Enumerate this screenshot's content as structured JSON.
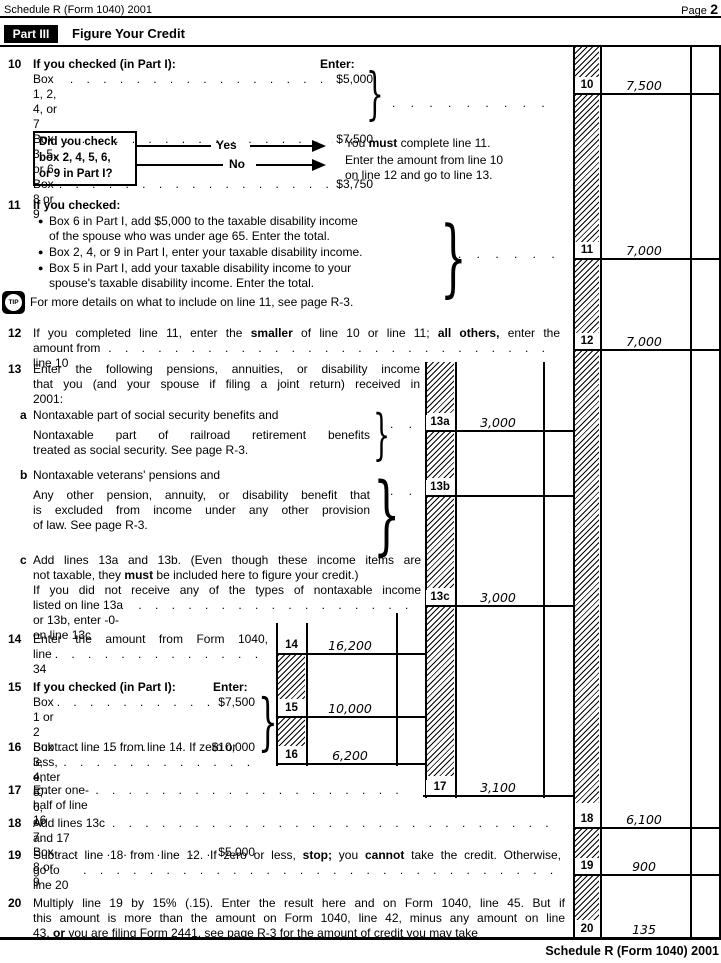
{
  "header": {
    "form_id": "Schedule R (Form 1040) 2001",
    "page_word": "Page",
    "page_number": "2",
    "part_label": "Part III",
    "part_title": "Figure Your Credit"
  },
  "glyphs": {
    "brace": "}",
    "bullet": "●",
    "tip": "TIP",
    "leader_dots": ". . . . . . . . . . . . . . . . . . . . . . . . . . . . . . . . . . . . . . . ."
  },
  "flowchart": {
    "question_lines": [
      "Did you check",
      "box 2, 4, 5, 6,",
      "or 9 in Part I?"
    ],
    "yes_label": "Yes",
    "no_label": "No",
    "yes_result": [
      {
        "t": "You "
      },
      {
        "t": "must",
        "b": true
      },
      {
        "t": " complete line 11."
      }
    ],
    "no_result_line1": "Enter the amount from line 10",
    "no_result_line2": "on line 12 and go to line 13."
  },
  "tip_text": "For more details on what to include on line 11, see page R-3.",
  "l10": {
    "no": "10",
    "intro": "If you checked (in Part I):",
    "enter_label": "Enter:",
    "items": [
      {
        "label": "Box 1, 2, 4, or 7",
        "amount": "$5,000"
      },
      {
        "label": "Box 3, 5, or 6",
        "amount": "$7,500"
      },
      {
        "label": "Box 8 or 9",
        "amount": "$3,750"
      }
    ]
  },
  "l11": {
    "no": "11",
    "intro": "If you checked:",
    "bullets": [
      {
        "lines": [
          "Box 6 in Part I, add $5,000 to the taxable disability income",
          "of the spouse who was under age 65. Enter the total."
        ]
      },
      {
        "lines": [
          "Box 2, 4, or 9 in Part I, enter your taxable disability income."
        ]
      },
      {
        "lines": [
          "Box 5 in Part I, add your taxable disability income to your",
          "spouse's taxable disability income. Enter the total."
        ]
      }
    ]
  },
  "l12": {
    "no": "12",
    "line1": [
      {
        "t": "If you completed line 11, enter the "
      },
      {
        "t": "smaller",
        "b": true
      },
      {
        "t": " of line 10 or line 11; "
      },
      {
        "t": "all others,",
        "b": true
      },
      {
        "t": " enter the"
      }
    ],
    "line2_text": "amount from line 10"
  },
  "l13": {
    "no": "13",
    "lines": [
      "Enter the following pensions, annuities, or disability income",
      "that you (and your spouse if filing a joint return) received in",
      "2001:"
    ],
    "a": {
      "letter": "a",
      "line1": "Nontaxable part of social security benefits and",
      "lines2": [
        "Nontaxable part of railroad retirement benefits",
        "treated as social security. See page R-3."
      ],
      "dots": ". ."
    },
    "b": {
      "letter": "b",
      "line1": "Nontaxable veterans' pensions and",
      "lines2": [
        "Any other pension, annuity, or disability benefit that",
        "is excluded from income under any other provision",
        "of law. See page R-3."
      ],
      "dots": ". ."
    },
    "c": {
      "letter": "c",
      "line1": "Add lines 13a and 13b. (Even though these income items are",
      "line2": [
        {
          "t": "not taxable, they "
        },
        {
          "t": "must",
          "b": true
        },
        {
          "t": " be included here to figure your credit.)"
        }
      ],
      "line3": "If you did not receive any of the types of nontaxable income",
      "line4_text": "listed on line 13a or 13b, enter -0- on line 13c"
    }
  },
  "l14": {
    "no": "14",
    "line1": "Enter the amount from Form 1040,",
    "line2_text": "line 34"
  },
  "l15": {
    "no": "15",
    "intro": "If you checked (in Part I):",
    "enter_label": "Enter:",
    "items": [
      {
        "label": "Box 1 or 2",
        "amount": "$7,500"
      },
      {
        "label": "Box 3, 4, 5, 6, or 7.",
        "amount": "$10,000"
      },
      {
        "label": "Box 8 or 9",
        "amount": "$5,000"
      }
    ]
  },
  "l16": {
    "no": "16",
    "line1": "Subtract line 15 from line 14. If zero or",
    "line2_text": "less, enter -0-"
  },
  "l17": {
    "no": "17",
    "text": "Enter one-half of line 16"
  },
  "l18": {
    "no": "18",
    "text": "Add lines 13c and 17"
  },
  "l19": {
    "no": "19",
    "line1": [
      {
        "t": "Subtract line 18 from line 12. If zero or less, "
      },
      {
        "t": "stop;",
        "b": true
      },
      {
        "t": " you "
      },
      {
        "t": "cannot",
        "b": true
      },
      {
        "t": " take the credit. Otherwise,"
      }
    ],
    "line2_text": "go to line 20"
  },
  "l20": {
    "no": "20",
    "lines": [
      [
        {
          "t": "Multiply line 19 by 15% (.15). Enter the result here and on Form 1040, line 45. But if"
        }
      ],
      [
        {
          "t": "this amount is more than the amount on Form 1040, line 42, minus any amount on line"
        }
      ],
      [
        {
          "t": "43, "
        },
        {
          "t": "or",
          "b": true
        },
        {
          "t": " you are filing Form 2441, see page R-3 for the amount of credit you may take"
        }
      ]
    ]
  },
  "boxes": {
    "b10": {
      "label": "10",
      "value": "7,500"
    },
    "b11": {
      "label": "11",
      "value": "7,000"
    },
    "b12": {
      "label": "12",
      "value": "7,000"
    },
    "b13a": {
      "label": "13a",
      "value": "3,000"
    },
    "b13b": {
      "label": "13b",
      "value": ""
    },
    "b13c": {
      "label": "13c",
      "value": "3,000"
    },
    "b14": {
      "label": "14",
      "value": "16,200"
    },
    "b15": {
      "label": "15",
      "value": "10,000"
    },
    "b16": {
      "label": "16",
      "value": "6,200"
    },
    "b17": {
      "label": "17",
      "value": "3,100"
    },
    "b18": {
      "label": "18",
      "value": "6,100"
    },
    "b19": {
      "label": "19",
      "value": "900"
    },
    "b20": {
      "label": "20",
      "value": "135"
    }
  },
  "footer": "Schedule R (Form 1040) 2001"
}
